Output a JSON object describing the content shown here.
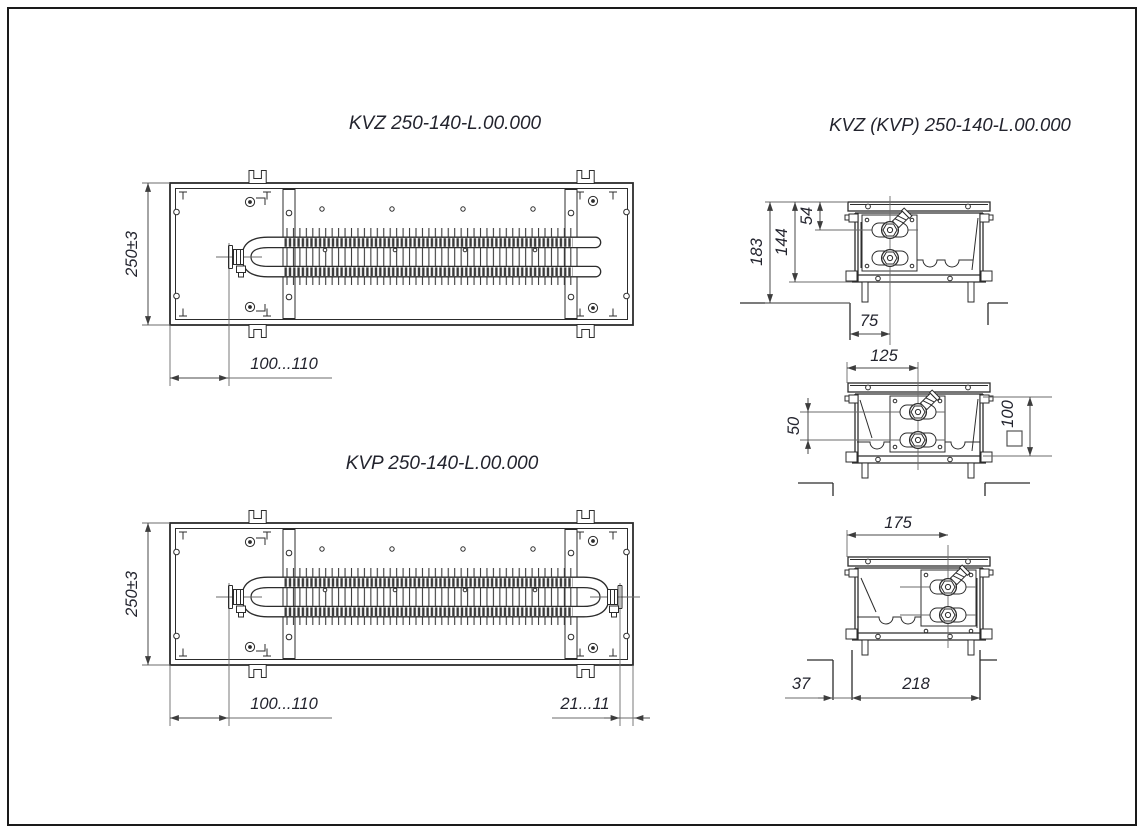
{
  "page": {
    "background": "#ffffff",
    "frame_color": "#1a1a1a",
    "object_line_color": "#2c2c2c",
    "dim_line_color": "#6b6b6b",
    "text_color": "#23242e"
  },
  "titles": {
    "kvz_plan": "KVZ 250-140-L.00.000",
    "kvp_plan": "KVP 250-140-L.00.000",
    "sections": "KVZ (KVP) 250-140-L.00.000"
  },
  "kvz": {
    "dim_height": "250±3",
    "dim_valve_offset": "100...110"
  },
  "kvp": {
    "dim_height": "250±3",
    "dim_valve_offset": "100...110",
    "dim_right_offset": "21...11"
  },
  "sections": {
    "dim_total_height": "183",
    "dim_casing_height": "144",
    "dim_pipe_depth": "54",
    "dim_pipe_offset_top": "75",
    "dim_pipe_offset_mid": "125",
    "dim_pipe_spacing": "50",
    "dim_inner_height": "100",
    "dim_pipe_offset_bottom": "175",
    "dim_floor_step": "37",
    "dim_recess_width": "218"
  }
}
